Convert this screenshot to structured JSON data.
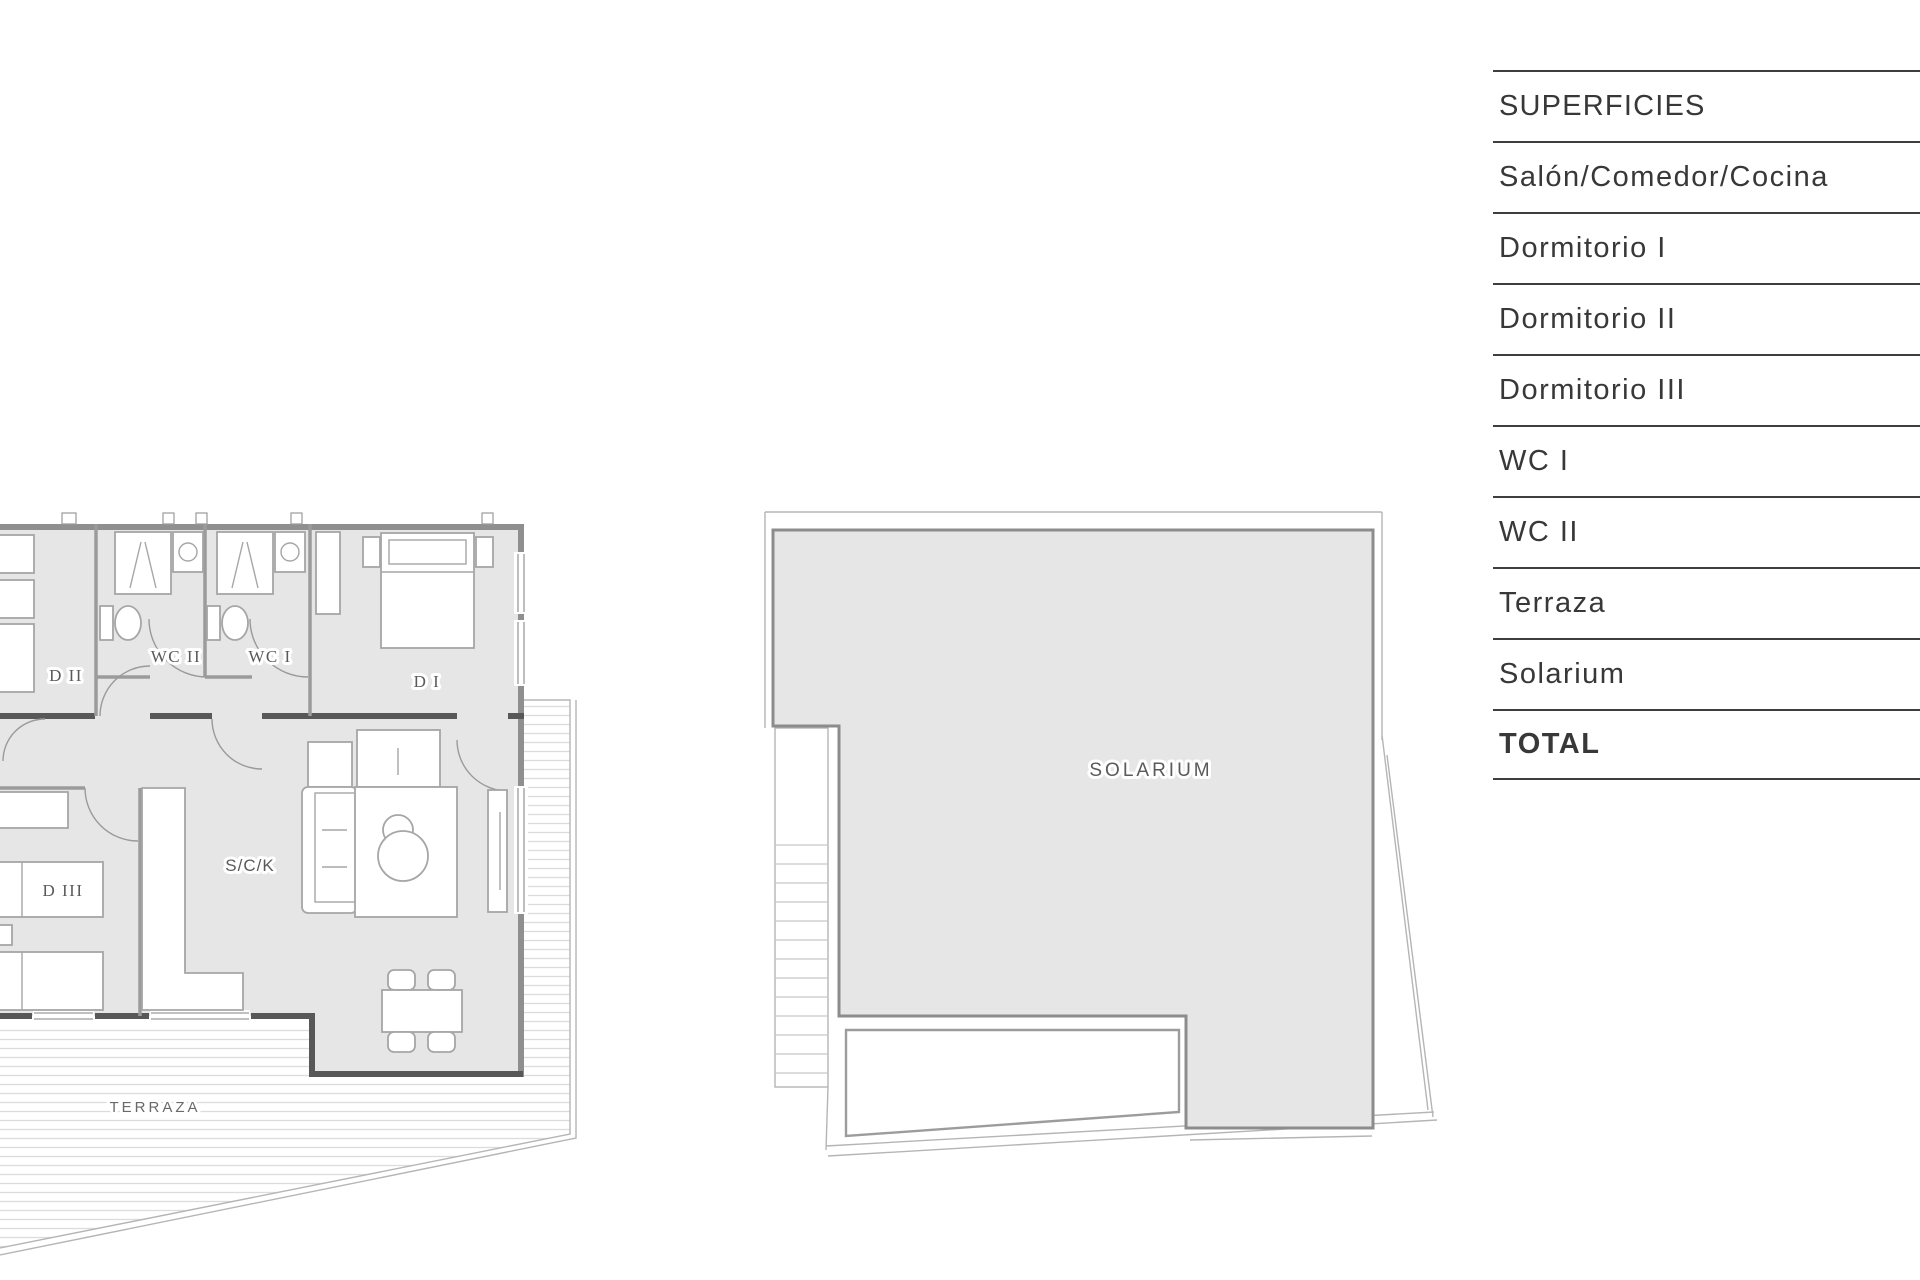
{
  "table": {
    "header": "SUPERFICIES",
    "rows": [
      "Salón/Comedor/Cocina",
      "Dormitorio I",
      "Dormitorio II",
      "Dormitorio III",
      "WC I",
      "WC II",
      "Terraza",
      "Solarium"
    ],
    "total_label": "TOTAL"
  },
  "apartment_plan": {
    "labels": {
      "dormitorio_1": "D I",
      "dormitorio_2": "D II",
      "dormitorio_3": "D III",
      "wc_1": "WC I",
      "wc_2": "WC II",
      "salon_comedor_cocina": "S/C/K",
      "terraza": "TERRAZA"
    }
  },
  "solarium_plan": {
    "label": "SOLARIUM"
  },
  "colors": {
    "floor": "#e6e6e6",
    "wall": "#8f8f8f",
    "wall_dark": "#585858",
    "hatch": "#dcdcdc",
    "boundary": "#b5b5b5",
    "furn": "#a6a6a6",
    "table_line": "#3e3e3e",
    "text": "#383838",
    "plan_label": "#5a5a5a"
  }
}
